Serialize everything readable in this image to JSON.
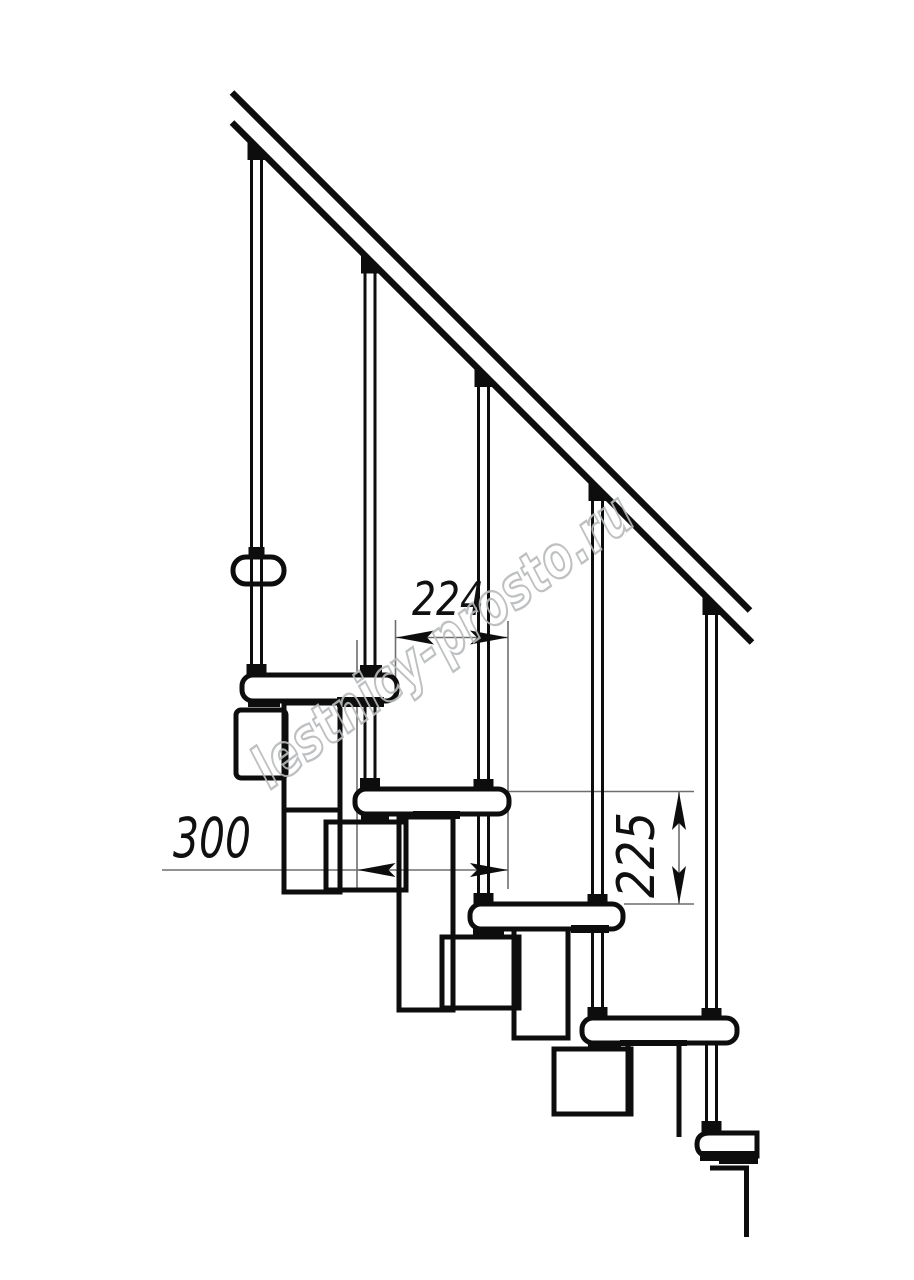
{
  "page": {
    "title": "Modular staircase side elevation technical drawing",
    "background": "#ffffff"
  },
  "drawing": {
    "type": "technical-line-drawing",
    "stroke_color": "#0d0d0d",
    "thin_line_color": "#6e6e6e",
    "components": {
      "handrail_count": 1,
      "balusters_count": 5,
      "treads_count": 5,
      "upper_flight_end_view_treads": 1,
      "support_module_boxes": 8
    },
    "dimensions": {
      "going": {
        "value": "224",
        "orientation": "horizontal"
      },
      "tread_depth": {
        "value": "300",
        "orientation": "horizontal"
      },
      "riser_height": {
        "value": "225",
        "orientation": "vertical"
      }
    }
  },
  "watermark": {
    "text": "lestnicy-prosto.ru",
    "color": "#b7babc",
    "angle_deg": -36
  }
}
